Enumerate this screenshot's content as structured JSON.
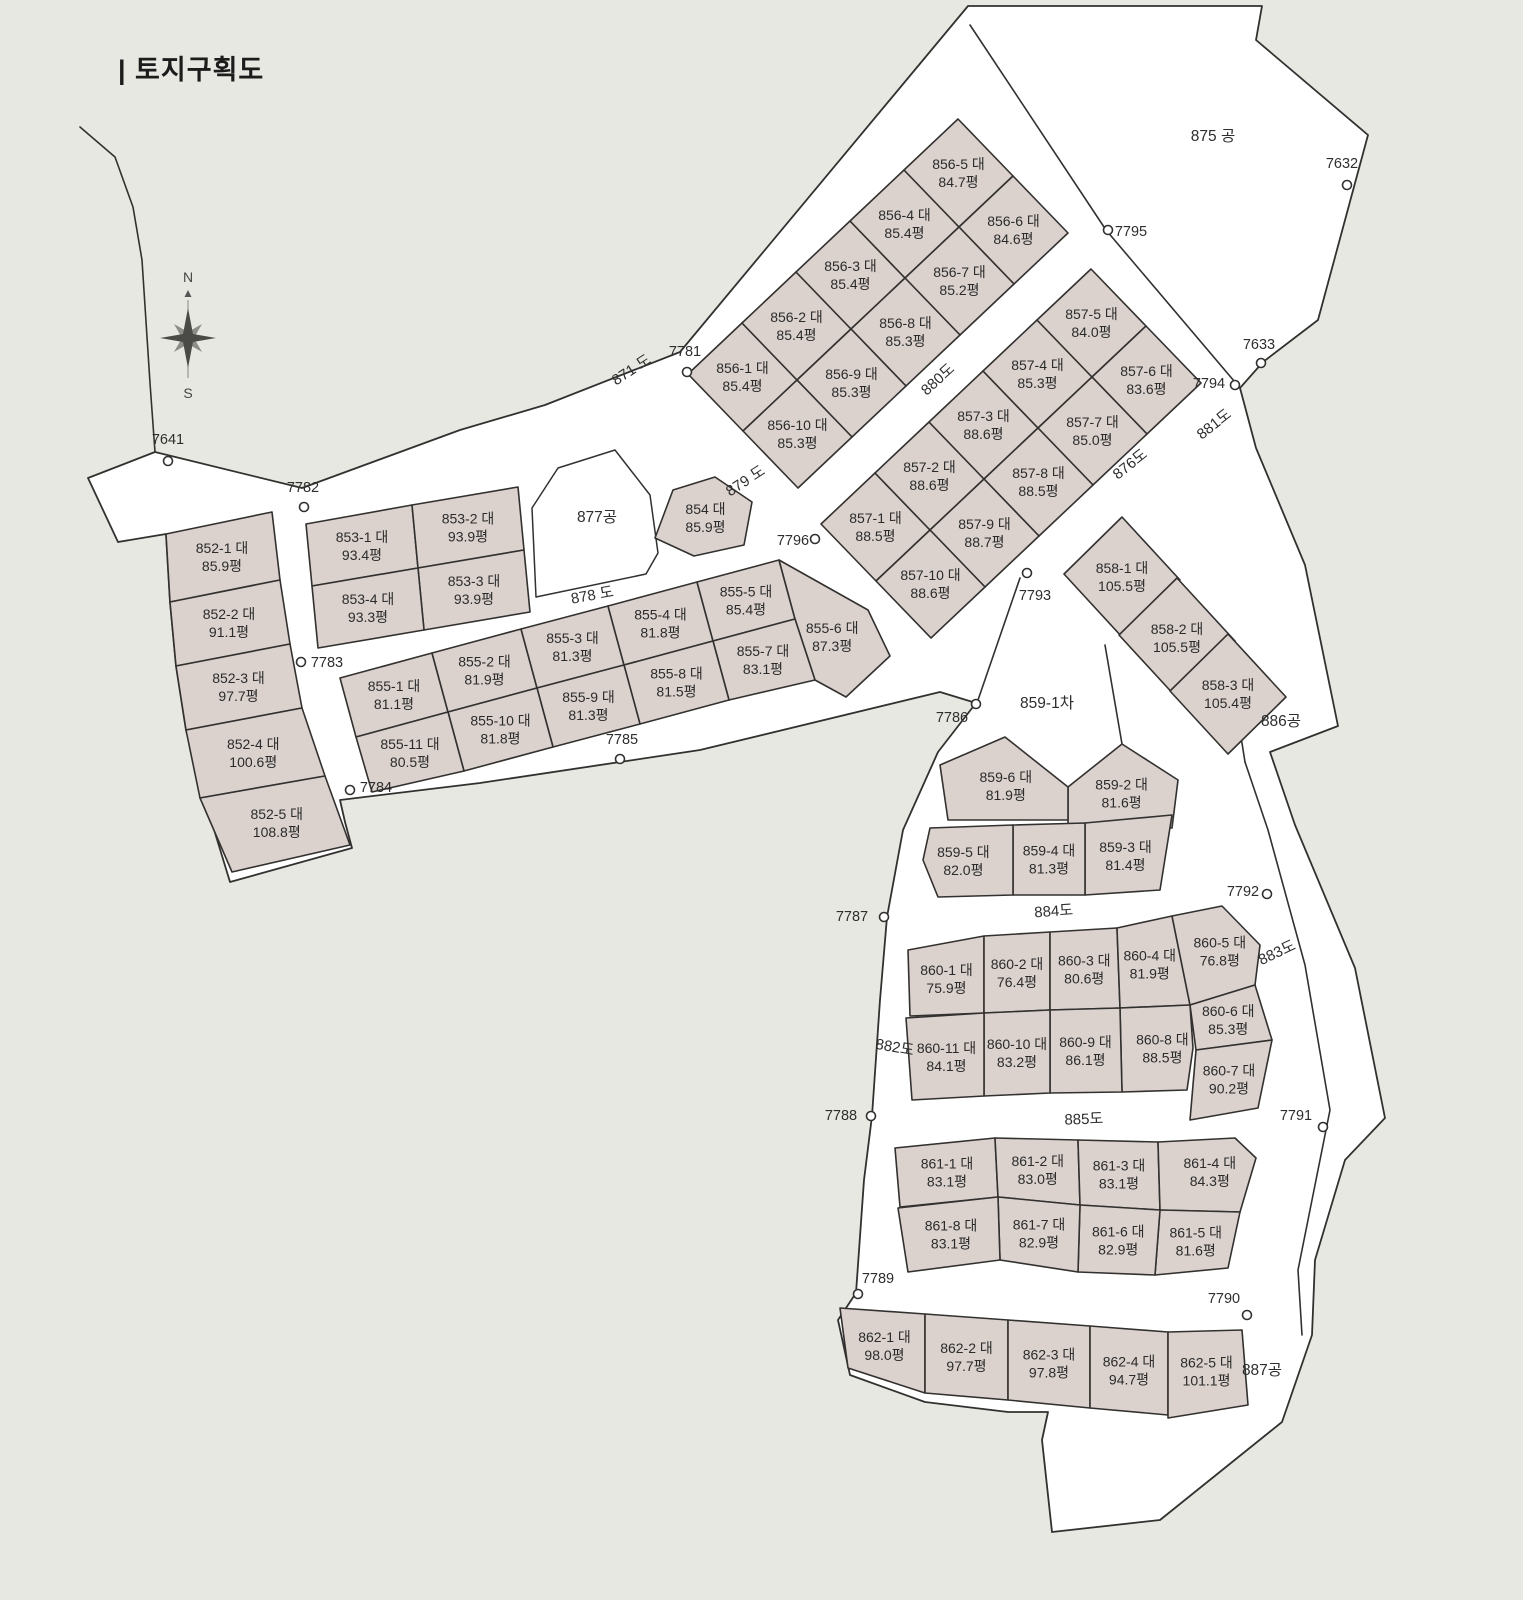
{
  "title": "| 토지구획도",
  "compass": {
    "north": "N",
    "south": "S"
  },
  "colors": {
    "background": "#e8e8e2",
    "site_fill": "#ffffff",
    "parcel_fill": "#dbd2ce",
    "line": "#33312f"
  },
  "site_outline": "968,6 1262,6 1256,40 1368,135 1318,320 1263,362 1240,388 1256,448 1305,565 1338,726 1270,752 1295,825 1355,968 1385,1118 1345,1160 1315,1260 1312,1335 1282,1422 1160,1520 1052,1532 1042,1440 1048,1412 1008,1412 925,1402 850,1375 838,1320 856,1293 864,1180 872,1116 880,1000 887,917 903,830 938,752 976,703 940,692 700,750 480,783 340,800 345,822 352,848 230,882 205,800 186,730 176,666 170,602 166,534 118,542 88,478 155,452 302,488 460,430 545,405 680,352",
  "boundary_lines": [
    {
      "name": "park-875-south-edge",
      "points": "970,25 1106,230 1240,388"
    },
    {
      "name": "notch-859-west-edge",
      "points": "1020,578 978,700"
    },
    {
      "name": "notch-859-east-edge",
      "points": "1105,645 1122,744"
    },
    {
      "name": "park-886-southwest-edge",
      "points": "1228,655 1245,762"
    },
    {
      "name": "road-883-east-edge",
      "points": "1245,762 1268,830 1305,965 1330,1110 1312,1200 1298,1270 1302,1335"
    },
    {
      "name": "west-outer-boundary",
      "points": "80,127 115,157 133,207 142,260 150,383 155,452"
    }
  ],
  "zones": [
    {
      "label": "875 공",
      "x": 1213,
      "y": 141
    },
    {
      "label": "877공",
      "x": 597,
      "y": 522,
      "outline": "532,508 558,468 615,450 650,495 658,553 646,574 536,597"
    },
    {
      "label": "886공",
      "x": 1281,
      "y": 726
    },
    {
      "label": "887공",
      "x": 1262,
      "y": 1375
    },
    {
      "label": "859-1차",
      "x": 1047,
      "y": 708
    }
  ],
  "roads": [
    {
      "label": "871 도",
      "x": 634,
      "y": 374,
      "rotate": -33
    },
    {
      "label": "879 도",
      "x": 748,
      "y": 485,
      "rotate": -33
    },
    {
      "label": "878 도",
      "x": 593,
      "y": 600,
      "rotate": -10
    },
    {
      "label": "880도",
      "x": 941,
      "y": 383,
      "rotate": -42
    },
    {
      "label": "876도",
      "x": 1133,
      "y": 468,
      "rotate": -38
    },
    {
      "label": "881도",
      "x": 1217,
      "y": 428,
      "rotate": -38
    },
    {
      "label": "882도",
      "x": 894,
      "y": 1052,
      "rotate": 10
    },
    {
      "label": "883도",
      "x": 1279,
      "y": 957,
      "rotate": -25
    },
    {
      "label": "884도",
      "x": 1054,
      "y": 916,
      "rotate": -4
    },
    {
      "label": "885도",
      "x": 1084,
      "y": 1124,
      "rotate": -2
    }
  ],
  "points": [
    {
      "label": "7641",
      "lx": 168,
      "ly": 444,
      "cx": 168,
      "cy": 461
    },
    {
      "label": "7782",
      "lx": 303,
      "ly": 492,
      "cx": 304,
      "cy": 507
    },
    {
      "label": "7783",
      "lx": 327,
      "ly": 667,
      "cx": 301,
      "cy": 662
    },
    {
      "label": "7784",
      "lx": 376,
      "ly": 792,
      "cx": 350,
      "cy": 790
    },
    {
      "label": "7785",
      "lx": 622,
      "ly": 744,
      "cx": 620,
      "cy": 759
    },
    {
      "label": "7781",
      "lx": 685,
      "ly": 356,
      "cx": 687,
      "cy": 372
    },
    {
      "label": "7796",
      "lx": 793,
      "ly": 545,
      "cx": 815,
      "cy": 539
    },
    {
      "label": "7786",
      "lx": 952,
      "ly": 722,
      "cx": 976,
      "cy": 704
    },
    {
      "label": "7787",
      "lx": 852,
      "ly": 921,
      "cx": 884,
      "cy": 917
    },
    {
      "label": "7788",
      "lx": 841,
      "ly": 1120,
      "cx": 871,
      "cy": 1116
    },
    {
      "label": "7789",
      "lx": 878,
      "ly": 1283,
      "cx": 858,
      "cy": 1294
    },
    {
      "label": "7790",
      "lx": 1224,
      "ly": 1303,
      "cx": 1247,
      "cy": 1315
    },
    {
      "label": "7791",
      "lx": 1296,
      "ly": 1120,
      "cx": 1323,
      "cy": 1127
    },
    {
      "label": "7792",
      "lx": 1243,
      "ly": 896,
      "cx": 1267,
      "cy": 894
    },
    {
      "label": "7793",
      "lx": 1035,
      "ly": 600,
      "cx": 1027,
      "cy": 573
    },
    {
      "label": "7794",
      "lx": 1209,
      "ly": 388,
      "cx": 1235,
      "cy": 385
    },
    {
      "label": "7795",
      "lx": 1131,
      "ly": 236,
      "cx": 1108,
      "cy": 230
    },
    {
      "label": "7632",
      "lx": 1342,
      "ly": 168,
      "cx": 1347,
      "cy": 185
    },
    {
      "label": "7633",
      "lx": 1259,
      "ly": 349,
      "cx": 1261,
      "cy": 363
    }
  ],
  "blocks": [
    {
      "id": "852",
      "parcels": [
        {
          "name": "852-1 대",
          "area": "85.9평",
          "pts": "166,534 272,512 280,580 170,602"
        },
        {
          "name": "852-2 대",
          "area": "91.1평",
          "pts": "170,602 280,580 290,644 176,666"
        },
        {
          "name": "852-3 대",
          "area": "97.7평",
          "pts": "176,666 290,644 302,708 186,730"
        },
        {
          "name": "852-4 대",
          "area": "100.6평",
          "pts": "186,730 302,708 325,776 200,798"
        },
        {
          "name": "852-5 대",
          "area": "108.8평",
          "pts": "200,798 325,776 350,845 232,872"
        }
      ]
    },
    {
      "id": "853",
      "parcels": [
        {
          "name": "853-1 대",
          "area": "93.4평",
          "pts": "306,524 412,505 418,568 312,586"
        },
        {
          "name": "853-2 대",
          "area": "93.9평",
          "pts": "412,505 518,487 524,550 418,568"
        },
        {
          "name": "853-3 대",
          "area": "93.9평",
          "pts": "418,568 524,550 530,612 424,630"
        },
        {
          "name": "853-4 대",
          "area": "93.3평",
          "pts": "312,586 418,568 424,630 318,648"
        }
      ]
    },
    {
      "id": "854",
      "parcels": [
        {
          "name": "854 대",
          "area": "85.9평",
          "pts": "655,538 673,490 715,477 752,502 744,545 694,556"
        }
      ]
    },
    {
      "id": "855",
      "parcels": [
        {
          "name": "855-1 대",
          "area": "81.1평",
          "pts": "340,678 432,653 448,712 356,737"
        },
        {
          "name": "855-2 대",
          "area": "81.9평",
          "pts": "432,653 521,629 537,688 448,712"
        },
        {
          "name": "855-3 대",
          "area": "81.3평",
          "pts": "521,629 608,606 624,665 537,688"
        },
        {
          "name": "855-4 대",
          "area": "81.8평",
          "pts": "608,606 697,582 713,641 624,665"
        },
        {
          "name": "855-5 대",
          "area": "85.4평",
          "pts": "697,582 779,560 795,619 713,641"
        },
        {
          "name": "855-6 대",
          "area": "87.3평",
          "pts": "779,560 868,610 890,656 846,697 815,680 795,619"
        },
        {
          "name": "855-7 대",
          "area": "83.1평",
          "pts": "713,641 795,619 815,680 729,700"
        },
        {
          "name": "855-8 대",
          "area": "81.5평",
          "pts": "624,665 713,641 729,700 640,724"
        },
        {
          "name": "855-9 대",
          "area": "81.3평",
          "pts": "537,688 624,665 640,724 553,747"
        },
        {
          "name": "855-10 대",
          "area": "81.8평",
          "pts": "448,712 537,688 553,747 464,771"
        },
        {
          "name": "855-11 대",
          "area": "80.5평",
          "pts": "356,737 448,712 464,771 372,792"
        }
      ]
    },
    {
      "id": "856",
      "parcels": [
        {
          "name": "856-1 대",
          "area": "85.4평",
          "pts": "742,323 797,380 743,431 688,374"
        },
        {
          "name": "856-2 대",
          "area": "85.4평",
          "pts": "796,272 851,329 797,380 742,323"
        },
        {
          "name": "856-3 대",
          "area": "85.4평",
          "pts": "850,221 905,278 851,329 796,272"
        },
        {
          "name": "856-4 대",
          "area": "85.4평",
          "pts": "904,170 959,227 905,278 850,221"
        },
        {
          "name": "856-5 대",
          "area": "84.7평",
          "pts": "958,119 1013,176 959,227 904,170"
        },
        {
          "name": "856-6 대",
          "area": "84.6평",
          "pts": "1013,176 1068,233 1014,284 959,227"
        },
        {
          "name": "856-7 대",
          "area": "85.2평",
          "pts": "959,227 1014,284 960,335 905,278"
        },
        {
          "name": "856-8 대",
          "area": "85.3평",
          "pts": "905,278 960,335 906,386 851,329"
        },
        {
          "name": "856-9 대",
          "area": "85.3평",
          "pts": "851,329 906,386 852,437 797,380"
        },
        {
          "name": "856-10 대",
          "area": "85.3평",
          "pts": "797,380 852,437 798,488 743,431"
        }
      ]
    },
    {
      "id": "857",
      "parcels": [
        {
          "name": "857-1 대",
          "area": "88.5평",
          "pts": "875,473 930,530 876,581 821,524"
        },
        {
          "name": "857-2 대",
          "area": "88.6평",
          "pts": "929,422 984,479 930,530 875,473"
        },
        {
          "name": "857-3 대",
          "area": "88.6평",
          "pts": "983,371 1038,428 984,479 929,422"
        },
        {
          "name": "857-4 대",
          "area": "85.3평",
          "pts": "1037,320 1092,377 1038,428 983,371"
        },
        {
          "name": "857-5 대",
          "area": "84.0평",
          "pts": "1091,269 1146,326 1092,377 1037,320"
        },
        {
          "name": "857-6 대",
          "area": "83.6평",
          "pts": "1146,326 1201,383 1147,434 1092,377"
        },
        {
          "name": "857-7 대",
          "area": "85.0평",
          "pts": "1092,377 1147,434 1093,485 1038,428"
        },
        {
          "name": "857-8 대",
          "area": "88.5평",
          "pts": "1038,428 1093,485 1039,536 984,479"
        },
        {
          "name": "857-9 대",
          "area": "88.7평",
          "pts": "984,479 1039,536 985,587 930,530"
        },
        {
          "name": "857-10 대",
          "area": "88.6평",
          "pts": "930,530 985,587 931,638 876,581"
        }
      ]
    },
    {
      "id": "858",
      "parcels": [
        {
          "name": "858-1 대",
          "area": "105.5평",
          "pts": "1122,517 1180,580 1122,637 1064,574"
        },
        {
          "name": "858-2 대",
          "area": "105.5평",
          "pts": "1177,578 1235,641 1177,698 1119,635"
        },
        {
          "name": "858-3 대",
          "area": "105.4평",
          "pts": "1228,634 1286,697 1228,754 1170,691"
        }
      ]
    },
    {
      "id": "859",
      "parcels": [
        {
          "name": "859-2 대",
          "area": "81.6평",
          "pts": "1068,787 1122,744 1178,780 1172,828 1068,828"
        },
        {
          "name": "859-3 대",
          "area": "81.4평",
          "pts": "1085,823 1172,815 1160,890 1085,895"
        },
        {
          "name": "859-4 대",
          "area": "81.3평",
          "pts": "1013,825 1085,823 1085,895 1013,895"
        },
        {
          "name": "859-5 대",
          "area": "82.0평",
          "pts": "923,860 930,828 1013,825 1013,895 938,897"
        },
        {
          "name": "859-6 대",
          "area": "81.9평",
          "pts": "940,765 1005,737 1068,787 1068,820 948,820"
        }
      ]
    },
    {
      "id": "860",
      "parcels": [
        {
          "name": "860-1 대",
          "area": "75.9평",
          "pts": "908,950 984,936 984,1013 910,1016"
        },
        {
          "name": "860-2 대",
          "area": "76.4평",
          "pts": "984,936 1050,932 1050,1010 984,1013"
        },
        {
          "name": "860-3 대",
          "area": "80.6평",
          "pts": "1050,932 1117,928 1120,1008 1050,1010"
        },
        {
          "name": "860-4 대",
          "area": "81.9평",
          "pts": "1117,928 1172,916 1190,1005 1120,1008"
        },
        {
          "name": "860-5 대",
          "area": "76.8평",
          "pts": "1172,916 1222,906 1260,945 1255,985 1190,1005"
        },
        {
          "name": "860-6 대",
          "area": "85.3평",
          "pts": "1190,1005 1255,985 1272,1040 1196,1050"
        },
        {
          "name": "860-7 대",
          "area": "90.2평",
          "pts": "1196,1050 1272,1040 1258,1108 1190,1120"
        },
        {
          "name": "860-8 대",
          "area": "88.5평",
          "pts": "1120,1008 1190,1005 1193,1048 1187,1090 1122,1092"
        },
        {
          "name": "860-9 대",
          "area": "86.1평",
          "pts": "1050,1010 1120,1008 1122,1092 1050,1093"
        },
        {
          "name": "860-10 대",
          "area": "83.2평",
          "pts": "984,1013 1050,1010 1050,1093 984,1096"
        },
        {
          "name": "860-11 대",
          "area": "84.1평",
          "pts": "906,1018 984,1013 984,1096 912,1100"
        }
      ]
    },
    {
      "id": "861",
      "parcels": [
        {
          "name": "861-1 대",
          "area": "83.1평",
          "pts": "895,1148 995,1138 998,1197 900,1207"
        },
        {
          "name": "861-2 대",
          "area": "83.0평",
          "pts": "995,1138 1078,1140 1080,1205 998,1197"
        },
        {
          "name": "861-3 대",
          "area": "83.1평",
          "pts": "1078,1140 1158,1142 1160,1210 1080,1205"
        },
        {
          "name": "861-4 대",
          "area": "84.3평",
          "pts": "1158,1142 1235,1138 1256,1158 1240,1212 1160,1210"
        },
        {
          "name": "861-5 대",
          "area": "81.6평",
          "pts": "1160,1210 1240,1212 1228,1268 1155,1275"
        },
        {
          "name": "861-6 대",
          "area": "82.9평",
          "pts": "1080,1205 1160,1210 1155,1275 1078,1272"
        },
        {
          "name": "861-7 대",
          "area": "82.9평",
          "pts": "998,1197 1080,1205 1078,1272 1000,1260"
        },
        {
          "name": "861-8 대",
          "area": "83.1평",
          "pts": "898,1208 998,1197 1000,1260 908,1272"
        }
      ]
    },
    {
      "id": "862",
      "parcels": [
        {
          "name": "862-1 대",
          "area": "98.0평",
          "pts": "840,1308 925,1314 925,1393 848,1368"
        },
        {
          "name": "862-2 대",
          "area": "97.7평",
          "pts": "925,1314 1008,1320 1008,1400 925,1393"
        },
        {
          "name": "862-3 대",
          "area": "97.8평",
          "pts": "1008,1320 1090,1326 1090,1408 1008,1400"
        },
        {
          "name": "862-4 대",
          "area": "94.7평",
          "pts": "1090,1326 1168,1332 1168,1415 1090,1408"
        },
        {
          "name": "862-5 대",
          "area": "101.1평",
          "pts": "1168,1332 1242,1330 1248,1405 1168,1418"
        }
      ]
    }
  ]
}
